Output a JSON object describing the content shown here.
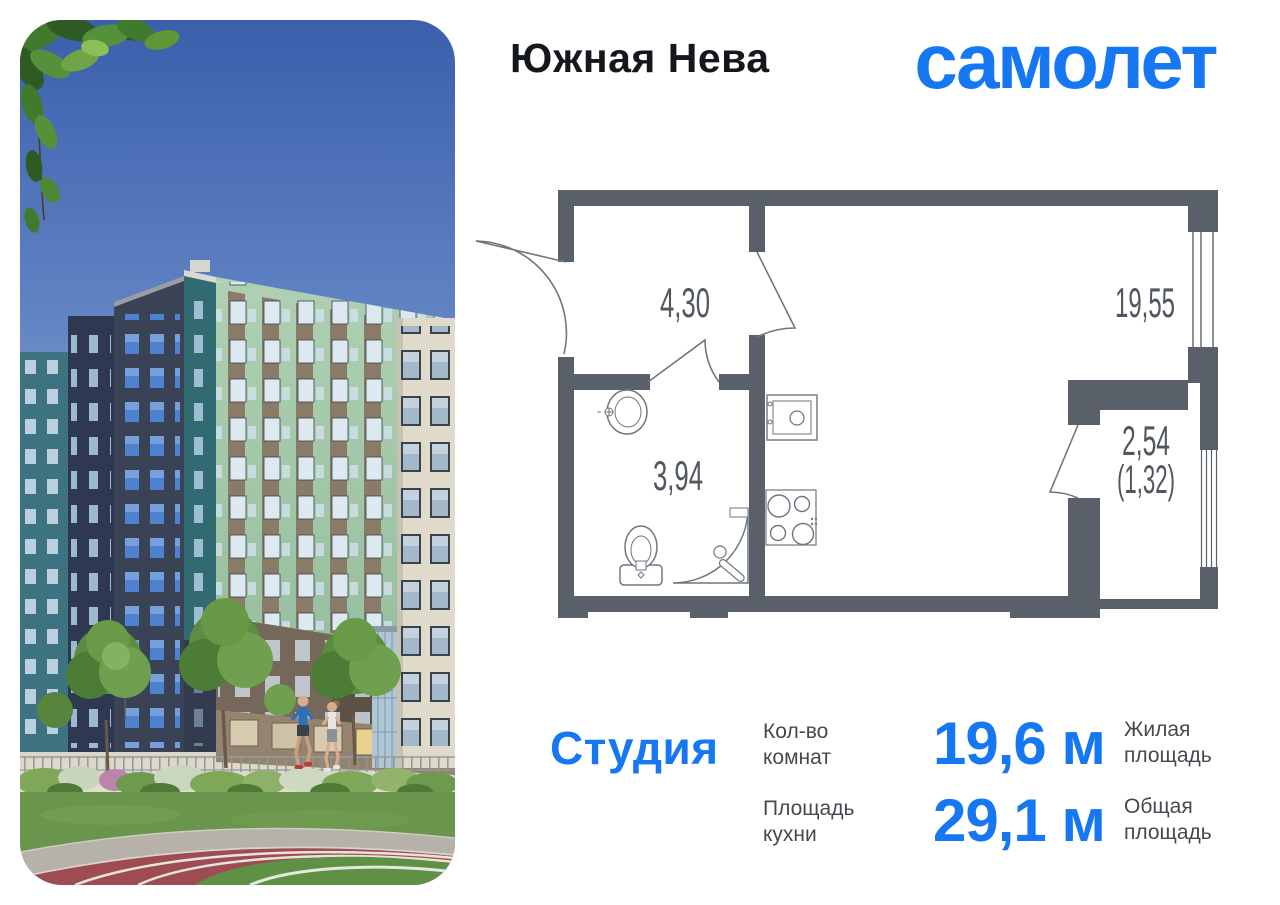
{
  "colors": {
    "accent_blue": "#1677F3",
    "wall_gray": "#59606A",
    "plan_text_gray": "#51575F",
    "label_gray": "#45494F",
    "title_black": "#14171B"
  },
  "header": {
    "project_title": "Южная Нева",
    "brand_logo": "самолет"
  },
  "floor_plan": {
    "hallway_area": "4,30",
    "living_room_area": "19,55",
    "bathroom_area": "3,94",
    "balcony_area": "2,54",
    "balcony_area_reduced": "(1,32)",
    "fixture_icons": [
      "bath-sink-icon",
      "toilet-icon",
      "shower-icon",
      "kitchen-sink-icon",
      "stove-icon",
      "window-icon",
      "door-swing-icon"
    ]
  },
  "details": {
    "apartment_type": "Студия",
    "rooms_count_label": "Кол-во комнат",
    "living_area_value": "19,6 м",
    "living_area_label": "Жилая площадь",
    "kitchen_area_label": "Площадь кухни",
    "total_area_value": "29,1 м",
    "total_area_label": "Общая площадь"
  }
}
